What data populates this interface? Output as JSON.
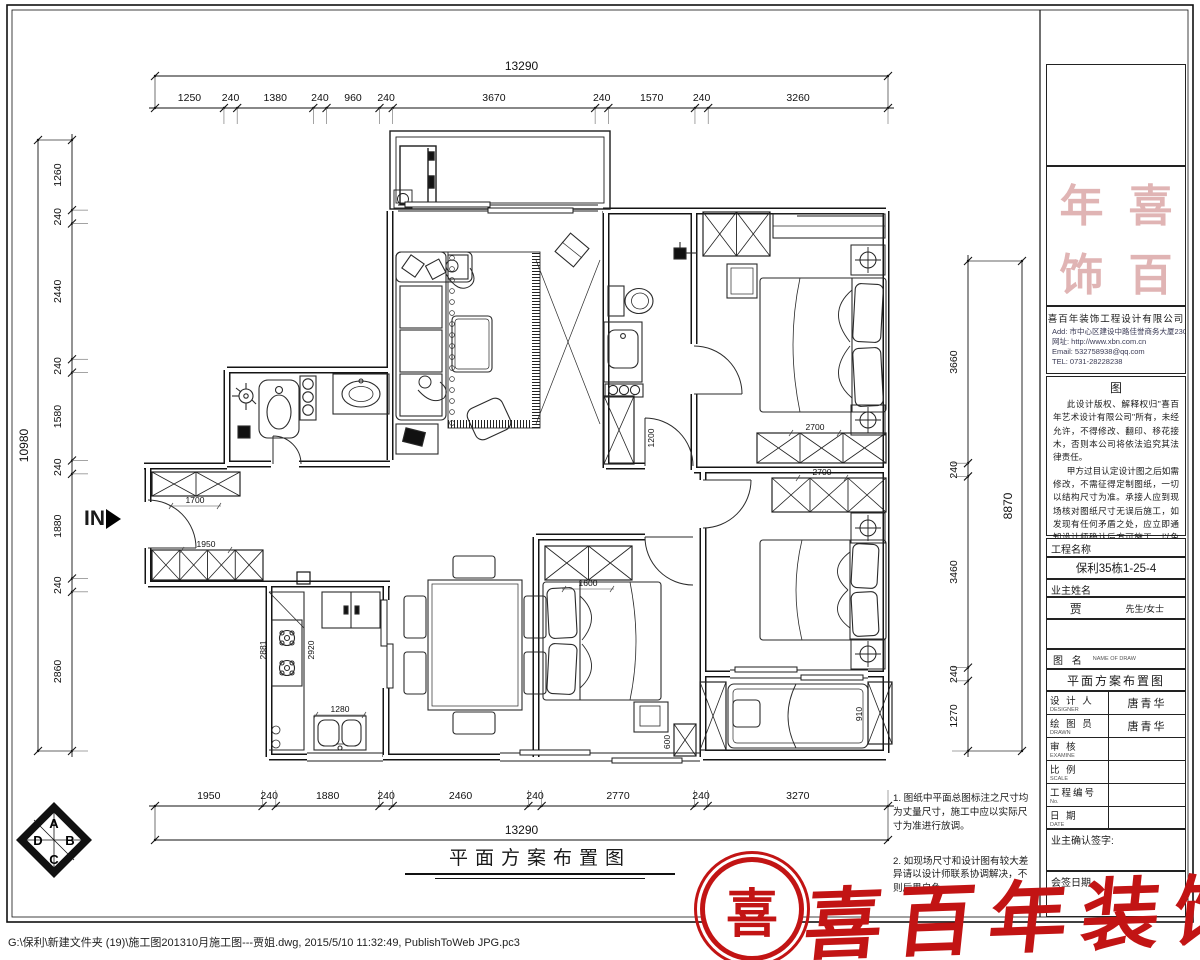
{
  "sheet": {
    "title": "平面方案布置图",
    "file_info": "G:\\保利\\新建文件夹 (19)\\施工图201310月施工图---贾姐.dwg, 2015/5/10 11:32:49, PublishToWeb JPG.pc3"
  },
  "entry": {
    "label": "IN"
  },
  "dimensions": {
    "top": {
      "overall": "13290",
      "segments": [
        "1250",
        "240",
        "1380",
        "240",
        "960",
        "240",
        "3670",
        "240",
        "1570",
        "240",
        "3260"
      ]
    },
    "bottom": {
      "overall": "13290",
      "segments": [
        "1950",
        "240",
        "1880",
        "240",
        "2460",
        "240",
        "2770",
        "240",
        "3270"
      ]
    },
    "left": {
      "overall": "10980",
      "segments": [
        "1260",
        "240",
        "2440",
        "240",
        "1580",
        "240",
        "1880",
        "240",
        "2860"
      ]
    },
    "right": {
      "overall": "8870",
      "segments": [
        "3660",
        "240",
        "3460",
        "240",
        "1270"
      ]
    }
  },
  "plan": {
    "interior_dims": [
      "1700",
      "1950",
      "2881",
      "2920",
      "1280",
      "2700",
      "2700",
      "1600",
      "1200",
      "600",
      "910"
    ]
  },
  "notes": {
    "n1": "1. 图纸中平面总图标注之尺寸均\n为丈量尺寸，施工中应以实际尺\n寸为准进行放调。",
    "n2": "2. 如现场尺寸和设计图有较大差\n异请以设计师联系协调解决，不\n则后果自负。"
  },
  "title_block": {
    "seal_chars": [
      "年",
      "喜",
      "饰",
      "百"
    ],
    "company": {
      "name": "喜百年装饰工程设计有限公司",
      "lines": [
        "Add: 市中心区建设中路佳誉商务大厦2308室",
        "网址: http://www.xbn.com.cn",
        "Email: 532758938@qq.com",
        "TEL: 0731-28228238"
      ]
    },
    "disclaimer": {
      "head": "图",
      "p1": "此设计版权、解释权归\"喜百年艺术设计有限公司\"所有，未经允许，不得修改、翻印、移花接木，否则本公司将依法追究其法律责任。",
      "p2": "甲方过目认定设计图之后如需修改，不需征得定制图纸，一切以结构尺寸为准。承接人应到现场核对图纸尺寸无误后施工，如发现有任何矛盾之处，应立即通知设计师确认后方可施工，以免造成损失。"
    },
    "project_label": "工程名称",
    "project_value": "保利35栋1-25-4",
    "owner_label": "业主姓名",
    "owner_name": "贾",
    "owner_suffix": "先生/女士",
    "drawing_name_label": "图  名",
    "drawing_name_sub": "NAME OF DRAW",
    "fields": [
      {
        "label": "设 计 人",
        "sub": "DESIGNER",
        "value": "唐青华"
      },
      {
        "label": "绘 图 员",
        "sub": "DRAWN",
        "value": "唐青华"
      },
      {
        "label": "审    核",
        "sub": "EXAMINE",
        "value": ""
      },
      {
        "label": "比    例",
        "sub": "SCALE",
        "value": ""
      },
      {
        "label": "工程编号",
        "sub": "No.",
        "value": ""
      },
      {
        "label": "日    期",
        "sub": "DATE",
        "value": ""
      },
      {
        "label": "图    号",
        "sub": "DWG No.",
        "value": "004"
      }
    ],
    "sign_label": "业主确认签字:",
    "countersign_label": "会签日期"
  },
  "logos": {
    "brand_text": "喜百年装饰",
    "emblem_char": "喜",
    "diamond_letters": [
      "A",
      "D",
      "B",
      "C"
    ]
  },
  "colors": {
    "brand_red": "#c21414",
    "seal_pink": "#e0b4b4",
    "line": "#1a1a1a"
  }
}
